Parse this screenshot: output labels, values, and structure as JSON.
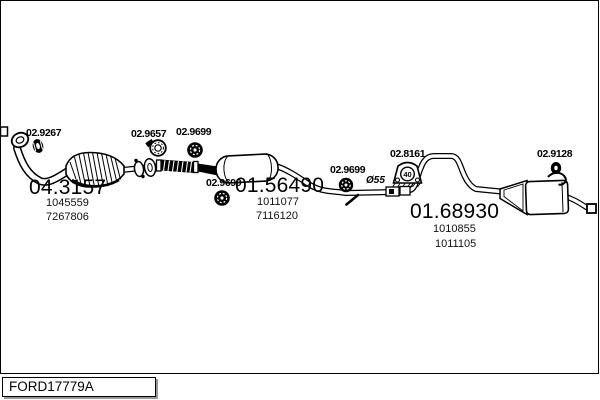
{
  "diagram": {
    "annotations": {
      "front_gasket": "02.9267",
      "front_clamp": "02.9657",
      "flex_gasket": "02.9699",
      "mid_gasket": "02.9699",
      "rear_gasket": "02.9699",
      "pipe_diameter": "Ø55",
      "rubber_hanger": "02.8161",
      "hanger_size": "40",
      "tail_ring": "02.9128"
    },
    "parts": {
      "catalyst": {
        "code": "04.3157",
        "numbers": [
          "1045559",
          "7267806"
        ]
      },
      "middle_muffler": {
        "code": "01.56490",
        "numbers": [
          "1011077",
          "7116120"
        ]
      },
      "rear_muffler": {
        "code": "01.68930",
        "numbers": [
          "1010855",
          "1011105"
        ]
      }
    },
    "colors": {
      "line": "#000000",
      "background": "#ffffff",
      "shadow": "#999999"
    }
  },
  "footer": {
    "reference": "FORD17779A"
  }
}
